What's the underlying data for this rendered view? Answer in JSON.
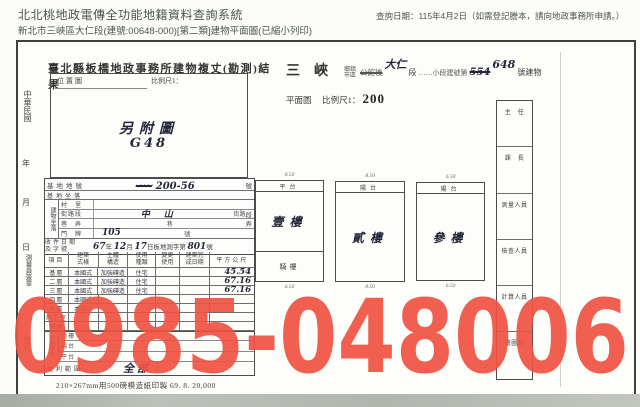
{
  "header": {
    "system_title": "北北桃地政電傳全功能地籍資料查詢系統",
    "query_date": "查詢日期：115年4月2日（如需登記謄本，請向地政事務所申請。）",
    "subtitle": "新北市三峽區大仁段(建號:00648-000)[第二類]建物平面圖(已縮小列印)"
  },
  "document": {
    "title": "臺北縣板橋地政事務所建物複丈(勘測)結果",
    "margin": {
      "era": "中華民國",
      "year": "年",
      "month": "月",
      "day": "日",
      "surveyor": "測量員簽章",
      "proof": "校正"
    },
    "location_box": {
      "label": "位置圖",
      "scale_label": "比例尺1：",
      "note": "另附圖",
      "code": "G48"
    },
    "form_head": {
      "town": "三峽",
      "town_unit": "鄉鎮市區",
      "old_section": "公館後",
      "section": "大仁",
      "section_unit": "段",
      "sub_unit": "……小段建號第",
      "old_no": "554",
      "no": "648",
      "suffix": "號建物",
      "plan": "平面圖",
      "scale_label": "比例尺1：",
      "scale_value": "200"
    },
    "site": {
      "lot_label": "基地地號",
      "lot_scribble": "〰〰",
      "lot_value": "200-56",
      "lot_unit": "號",
      "seat_label": "基地坐落",
      "group_label": "建物坐落",
      "village_label": "村　里",
      "street_label": "街路段",
      "street_value": "中山",
      "street_mid": "街路",
      "street_unit": "段",
      "lane_label": "巷　弄",
      "lane_mid": "巷",
      "lane_unit": "弄",
      "door_label": "門　牌",
      "door_value": "105",
      "door_unit": "號",
      "receipt_label1": "收件日期",
      "receipt_label2": "及字號",
      "receipt": {
        "y": "67",
        "y_unit": "年",
        "m": "12",
        "m_unit": "月",
        "d": "17",
        "d_unit": "日板地測字第",
        "no": "801",
        "no_unit": "號"
      }
    },
    "floors": {
      "headers": [
        "項目",
        "建築式樣",
        "主體構造",
        "使用種類",
        "變更使用",
        "建築完成日期",
        "平方公尺"
      ],
      "rows": [
        {
          "floor": "基層",
          "style": "本國式",
          "structure": "加強磚造",
          "use": "住宅",
          "area": "45.54"
        },
        {
          "floor": "二層",
          "style": "本國式",
          "structure": "加強磚造",
          "use": "住宅",
          "area": "67.16"
        },
        {
          "floor": "三層",
          "style": "本國式",
          "structure": "加強磚造",
          "use": "住宅",
          "area": "67.16"
        },
        {
          "floor": "四層",
          "style": "本國式",
          "structure": "",
          "use": "",
          "area": ""
        },
        {
          "floor": "五層",
          "style": "本國式",
          "structure": "",
          "use": "",
          "area": ""
        },
        {
          "floor": "地下室",
          "style": "",
          "structure": "",
          "use": "",
          "area": ""
        },
        {
          "floor": "騎樓",
          "style": "",
          "structure": "",
          "use": "",
          "area": ""
        }
      ]
    },
    "attached": {
      "group_label": "附屬建物",
      "rows": [
        "騎樓",
        "陽台",
        "平台"
      ],
      "rights_label": "權利範圍",
      "rights_value": "全部"
    },
    "plan_units": [
      {
        "top": "平台",
        "main": "壹樓",
        "bottom": "騎樓",
        "dim_top": "8.50",
        "dim_bottom": "6.50"
      },
      {
        "top": "陽台",
        "main": "貳樓",
        "bottom": "",
        "dim_top": "8.50",
        "dim_bottom": "8.50"
      },
      {
        "top": "陽台",
        "main": "參樓",
        "bottom": "",
        "dim_top": "6.50",
        "dim_bottom": "6.50"
      }
    ],
    "sidebar": [
      "主　任",
      "課　長",
      "測量人員",
      "檢查人員",
      "計算人員",
      "繪圖員"
    ],
    "footer": "210×267mm用500磅模造紙印製 69. 8. 20,000"
  },
  "watermark": {
    "text": "0985-048006",
    "color": "#ef5242"
  }
}
